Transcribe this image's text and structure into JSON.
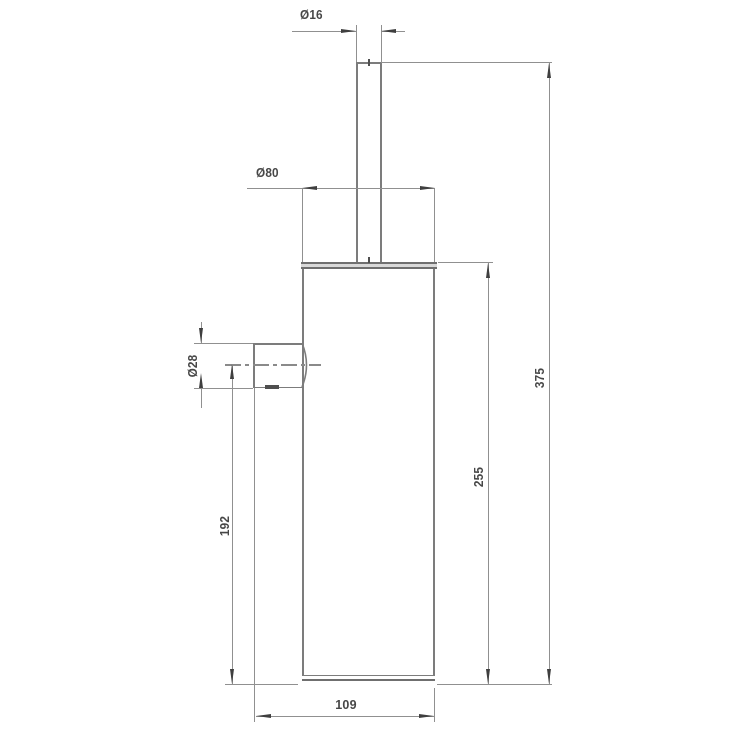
{
  "drawing": {
    "type": "technical-dimension-drawing",
    "labels": {
      "handle_dia": "Ø16",
      "body_dia": "Ø80",
      "mount_dia": "Ø28",
      "mount_center_height": "192",
      "body_height": "255",
      "total_height": "375",
      "depth": "109"
    },
    "colors": {
      "background": "#ffffff",
      "outline": "#7c7c7c",
      "dimension_line": "#909090",
      "arrow": "#3f3f3f",
      "text": "#474747"
    }
  }
}
